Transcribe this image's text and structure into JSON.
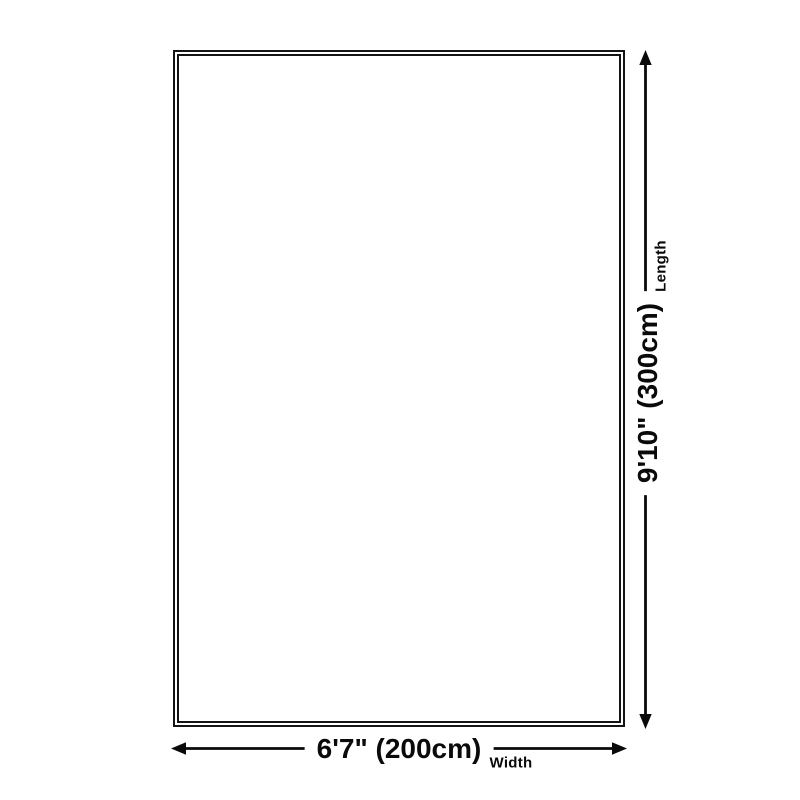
{
  "diagram": {
    "type": "product-dimension-diagram",
    "background_color": "#ffffff",
    "line_color": "#0a0a0a",
    "border_color": "#141414",
    "dimensions": {
      "length": {
        "value": "9'10\" (300cm)",
        "label": "Length",
        "orientation": "vertical"
      },
      "width": {
        "value": "6'7\" (200cm)",
        "label": "Width",
        "orientation": "horizontal"
      }
    }
  }
}
